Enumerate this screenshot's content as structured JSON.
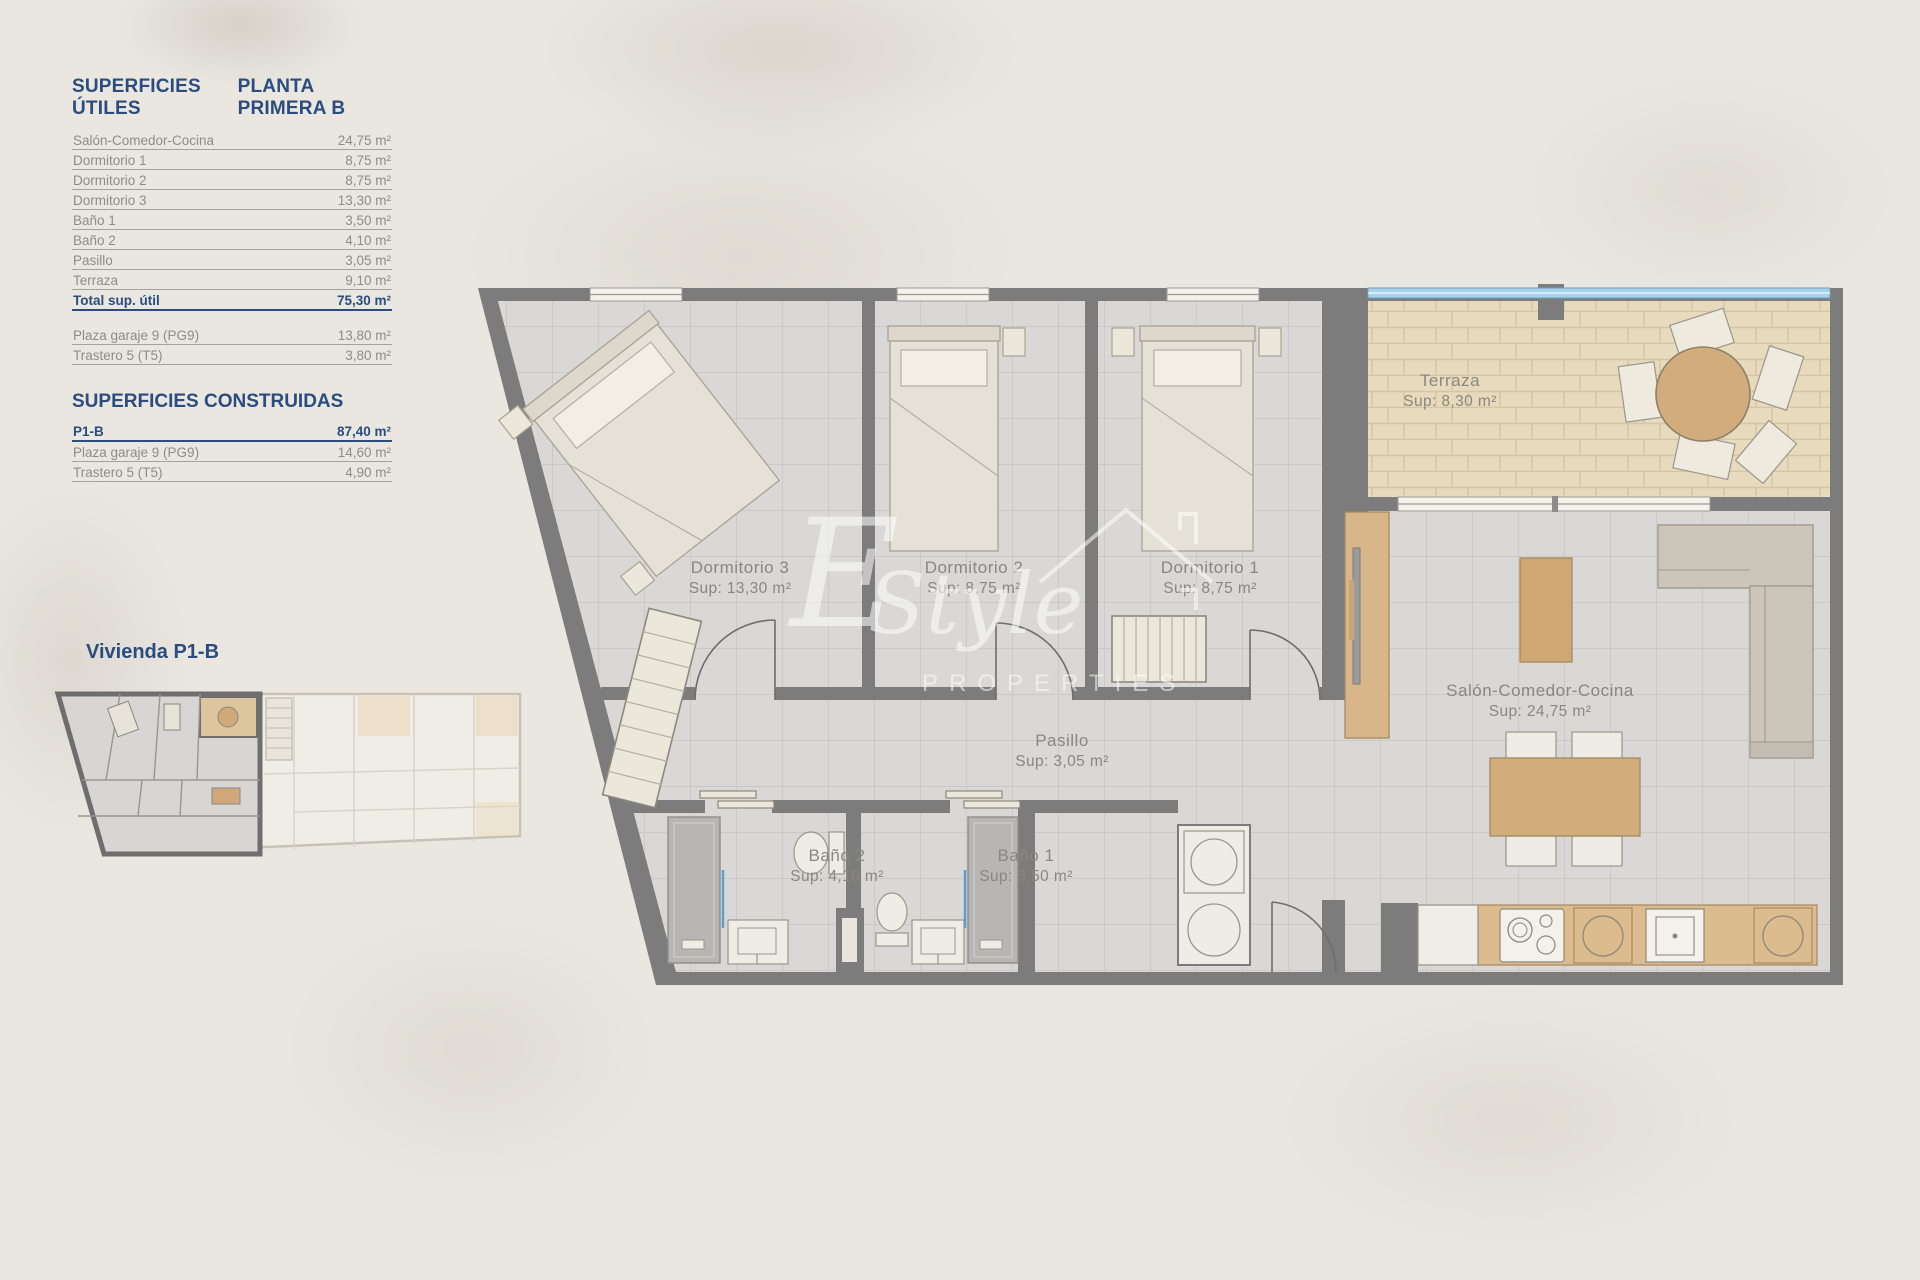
{
  "sidebar": {
    "title": "SUPERFICIES ÚTILES",
    "subtitle": "PLANTA PRIMERA B",
    "utiles": [
      {
        "label": "Salón-Comedor-Cocina",
        "value": "24,75 m²"
      },
      {
        "label": "Dormitorio 1",
        "value": "8,75 m²"
      },
      {
        "label": "Dormitorio 2",
        "value": "8,75 m²"
      },
      {
        "label": "Dormitorio 3",
        "value": "13,30 m²"
      },
      {
        "label": "Baño 1",
        "value": "3,50 m²"
      },
      {
        "label": "Baño 2",
        "value": "4,10 m²"
      },
      {
        "label": "Pasillo",
        "value": "3,05 m²"
      },
      {
        "label": "Terraza",
        "value": "9,10 m²"
      }
    ],
    "total": {
      "label": "Total sup. útil",
      "value": "75,30 m²"
    },
    "annex": [
      {
        "label": "Plaza garaje 9 (PG9)",
        "value": "13,80 m²"
      },
      {
        "label": "Trastero 5 (T5)",
        "value": "3,80 m²"
      }
    ],
    "construidas_title": "SUPERFICIES CONSTRUIDAS",
    "construidas": [
      {
        "label": "P1-B",
        "value": "87,40 m²"
      },
      {
        "label": "Plaza garaje 9 (PG9)",
        "value": "14,60 m²"
      },
      {
        "label": "Trastero 5 (T5)",
        "value": "4,90 m²"
      }
    ],
    "vivienda_label": "Vivienda P1-B"
  },
  "plan": {
    "rooms": [
      {
        "name": "Dormitorio 3",
        "sup": "Sup: 13,30 m²"
      },
      {
        "name": "Dormitorio 2",
        "sup": "Sup: 8,75 m²"
      },
      {
        "name": "Dormitorio 1",
        "sup": "Sup: 8,75 m²"
      },
      {
        "name": "Terraza",
        "sup": "Sup: 8,30 m²"
      },
      {
        "name": "Salón-Comedor-Cocina",
        "sup": "Sup: 24,75 m²"
      },
      {
        "name": "Pasillo",
        "sup": "Sup: 3,05 m²"
      },
      {
        "name": "Baño 2",
        "sup": "Sup: 4,10 m²"
      },
      {
        "name": "Baño 1",
        "sup": "Sup: 3,50 m²"
      }
    ],
    "watermark": {
      "initial": "E",
      "script": "Style",
      "caps": "PROPERTIES"
    }
  },
  "colors": {
    "heading_blue": "#2b4c7e",
    "table_text_gray": "#8f8c87",
    "wall_gray": "#7c7c7c",
    "floor_tile_gray": "#d9d8d6",
    "terrace_tan": "#e7dabd",
    "wood": "#d2ad7c",
    "glass_blue": "#a9d2ec"
  }
}
